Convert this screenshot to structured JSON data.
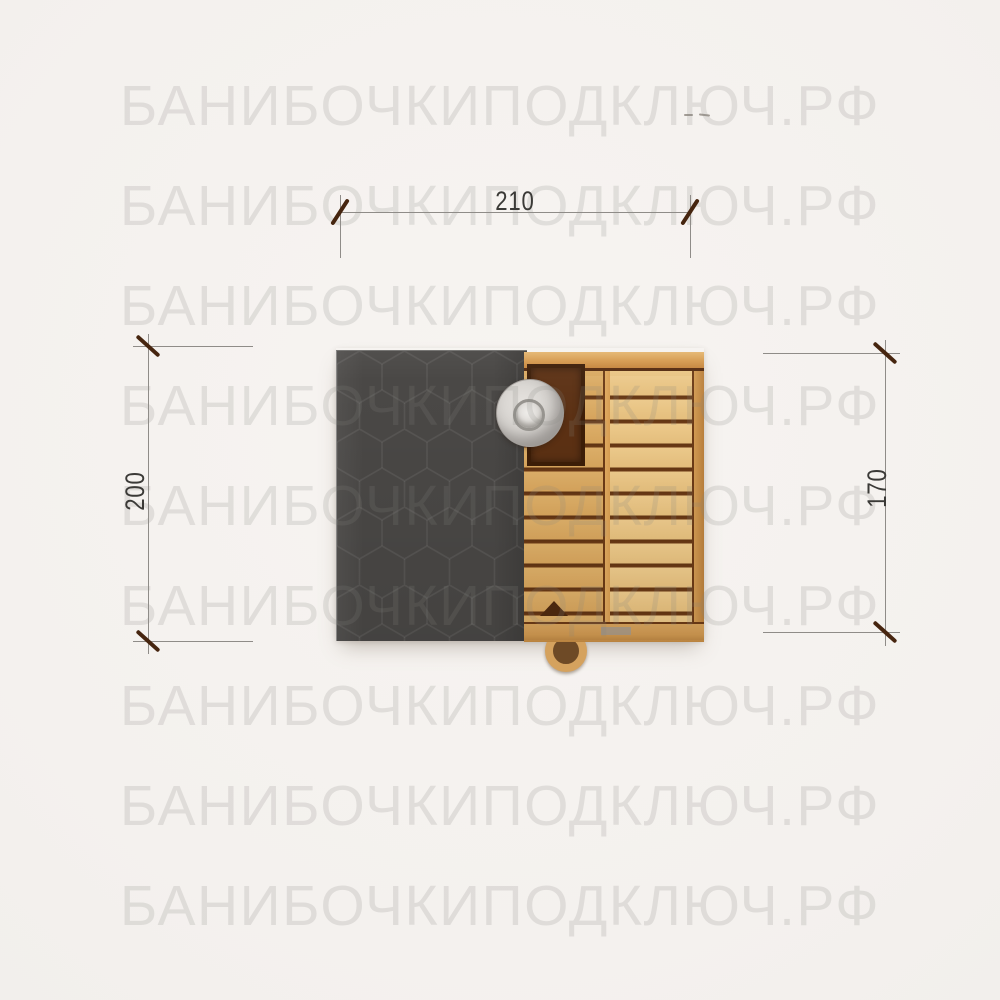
{
  "watermark": {
    "text": "БАНИБОЧКИПОДКЛЮЧ.РФ",
    "row_count": 9,
    "color": "#8a8783"
  },
  "dimensions": {
    "width_top": {
      "value": "210"
    },
    "depth_left": {
      "value": "200"
    },
    "depth_right": {
      "value": "170"
    }
  },
  "drawing": {
    "subject": "sauna-top-view",
    "colors": {
      "background": "#f5f2ef",
      "roof": "#4a4846",
      "wood_light": "#ecc98b",
      "wood_mid": "#dcae68",
      "wood_frame": "#cf9149",
      "plank_gap": "#5e3212",
      "window_opening": "#5b3013",
      "chimney_cap": "#d4d1cd",
      "dimension_line": "#8f8c88",
      "dimension_tick": "#46250f",
      "dimension_text": "#3b3a37"
    }
  }
}
